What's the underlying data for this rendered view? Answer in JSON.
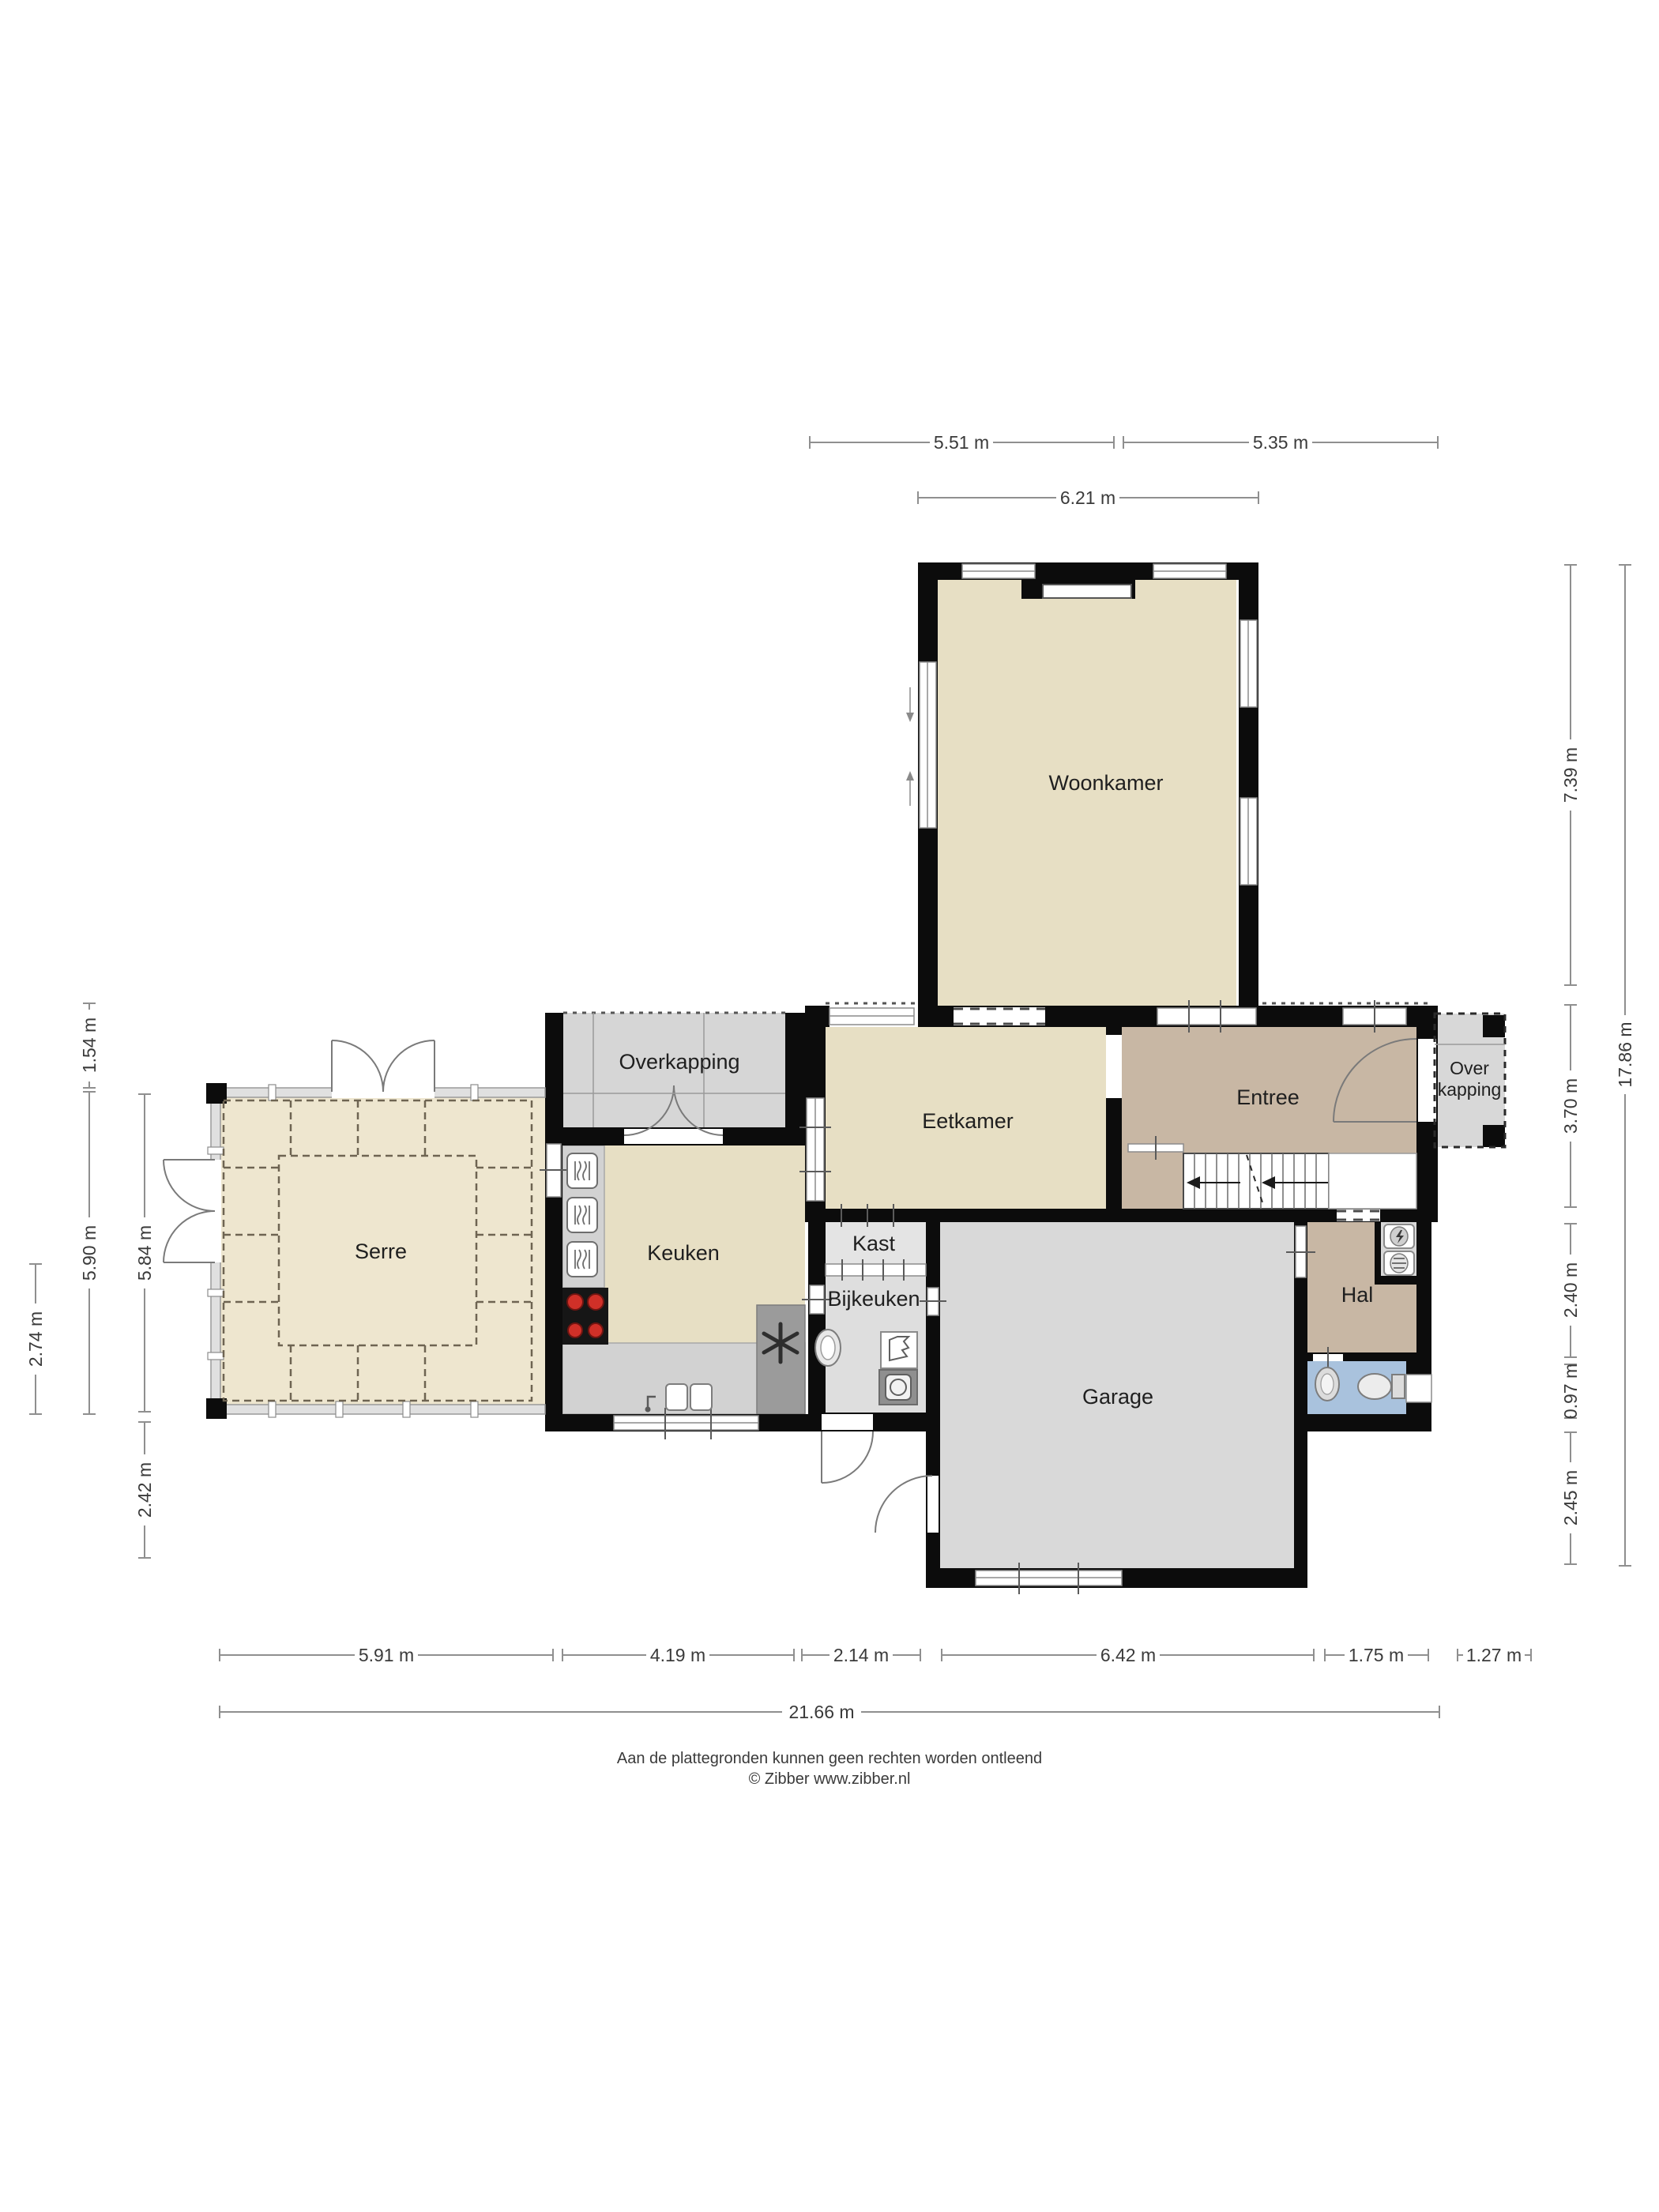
{
  "page": {
    "footer_line1": "Aan de plattegronden kunnen geen rechten worden ontleend",
    "footer_line2": "© Zibber www.zibber.nl"
  },
  "rooms": {
    "woonkamer": {
      "label": "Woonkamer"
    },
    "eetkamer": {
      "label": "Eetkamer"
    },
    "entree": {
      "label": "Entree"
    },
    "overkapping_noord": {
      "label": "Overkapping"
    },
    "overkapping_oost": {
      "label_line1": "Over",
      "label_line2": "kapping"
    },
    "serre": {
      "label": "Serre"
    },
    "keuken": {
      "label": "Keuken"
    },
    "kast": {
      "label": "Kast"
    },
    "bijkeuken": {
      "label": "Bijkeuken"
    },
    "garage": {
      "label": "Garage"
    },
    "hal": {
      "label": "Hal"
    }
  },
  "dimensions": {
    "top": [
      {
        "label": "5.51 m"
      },
      {
        "label": "5.35 m"
      },
      {
        "label": "6.21 m"
      }
    ],
    "bottom": [
      {
        "label": "5.91 m"
      },
      {
        "label": "4.19 m"
      },
      {
        "label": "2.14 m"
      },
      {
        "label": "6.42 m"
      },
      {
        "label": "1.75 m"
      },
      {
        "label": "1.27 m"
      },
      {
        "label": "21.66 m"
      }
    ],
    "left": [
      {
        "label": "1.54 m"
      },
      {
        "label": "5.90 m"
      },
      {
        "label": "2.74 m"
      },
      {
        "label": "5.84 m"
      },
      {
        "label": "2.42 m"
      }
    ],
    "right": [
      {
        "label": "7.39 m"
      },
      {
        "label": "3.70 m"
      },
      {
        "label": "2.40 m"
      },
      {
        "label": "0.97 m"
      },
      {
        "label": "2.45 m"
      },
      {
        "label": "17.86 m"
      }
    ]
  },
  "colors": {
    "floor_living": "#e7dfc4",
    "floor_serre": "#eee6cf",
    "floor_hall": "#c8b7a4",
    "floor_garage": "#d9d9d9",
    "floor_utility": "#dedede",
    "floor_toilet": "#a9c2dd",
    "wall": "#0c0c0c",
    "counter": "#d2d2d2",
    "cooktop_burner": "#d03028"
  },
  "icons": {
    "snowflake": "freezer",
    "steam_waves": "oven",
    "lightning": "boiler"
  }
}
